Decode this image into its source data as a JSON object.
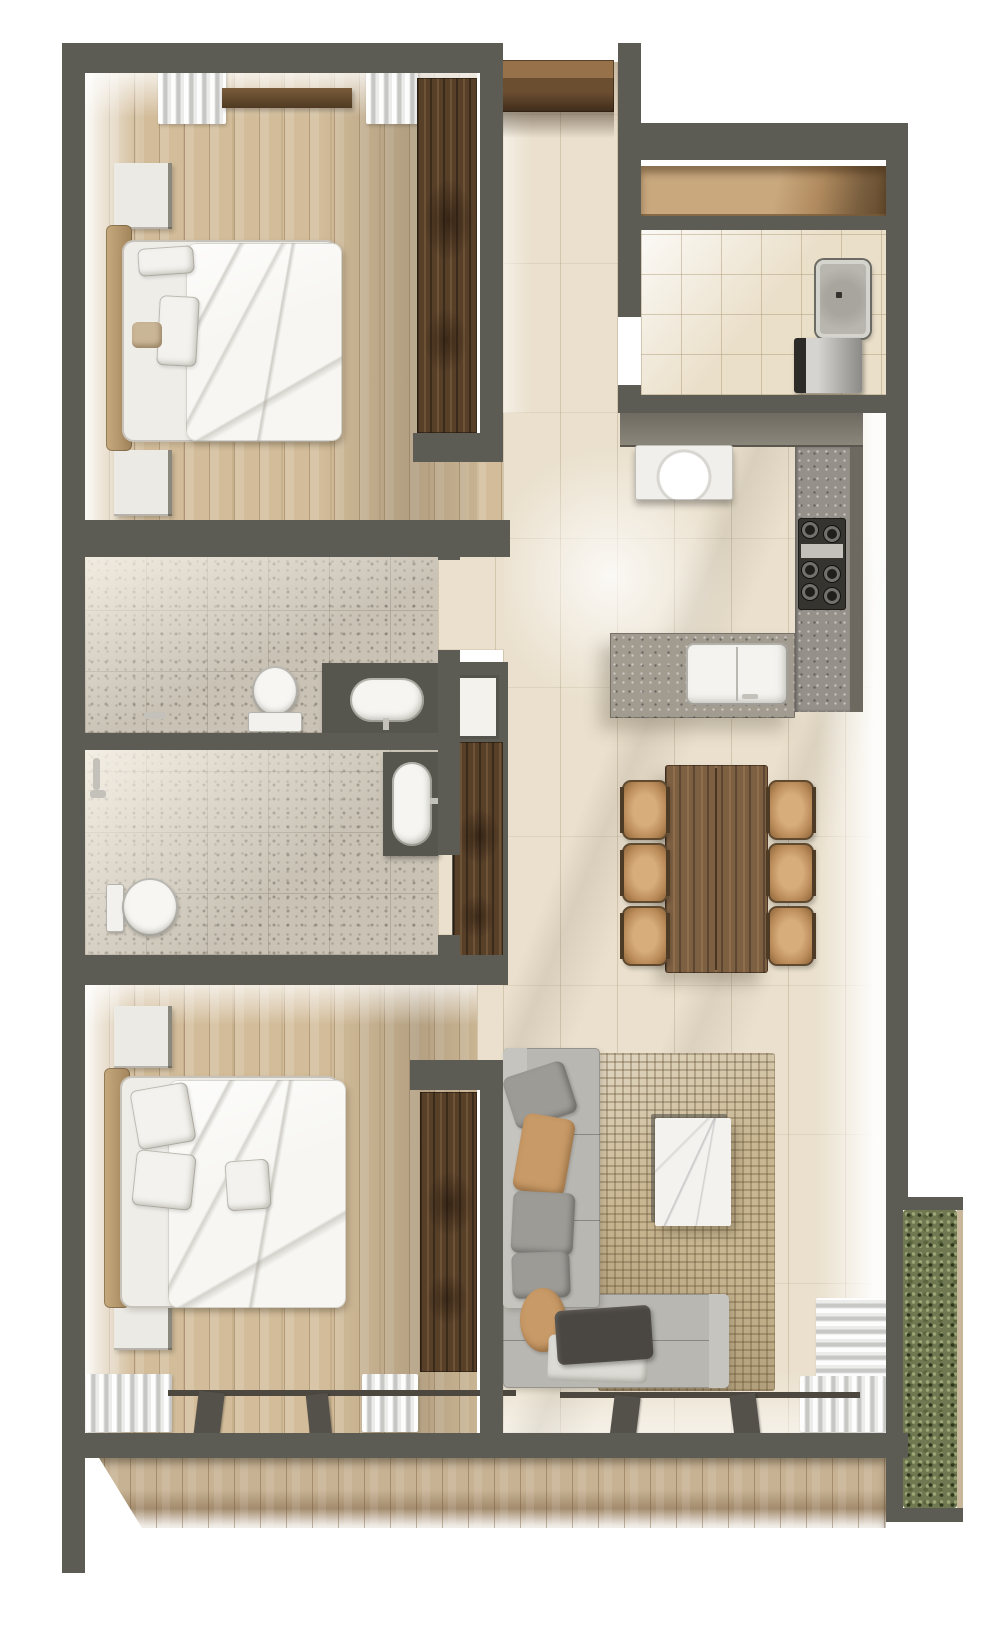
{
  "canvas": {
    "width_px": 1000,
    "height_px": 1641,
    "background": "#ffffff"
  },
  "scene": {
    "type": "3D rendered architectural floor plan",
    "view": "top-down",
    "subject": "two-bedroom apartment with terrace",
    "visible_text": "none"
  },
  "colors": {
    "wall": "#5d5c54",
    "travertine": "#eae0cd",
    "bedroomWood": "#d2bc99",
    "deckWood": "#c7b294",
    "darkWood": "#573f28",
    "terrazzo": "#c9c2b5",
    "creamTile": "#eadfc9",
    "counter": "#7c776d",
    "granite": "#95908a",
    "sofa": "#b9b7b1",
    "rug": "#c8b691",
    "hedge": "#6f7850",
    "fixtureWhite": "#f6f5f1",
    "leatherTan": "#c7a97e",
    "tableWood": "#7d5f42",
    "chairTan": "#c89a67",
    "marble": "#f4f2ee",
    "stove": "#35342f",
    "steel": "#c4c1bb"
  },
  "rooms": [
    {
      "id": "bedroom-1",
      "name": "Bedroom 1",
      "position": "top-left",
      "floor": "wood planks",
      "contents": [
        "double bed with white duvet",
        "two white nightstands",
        "tan headboard bench",
        "built-in dark wood wardrobe",
        "window curtains",
        "wood wall shelf"
      ]
    },
    {
      "id": "entry-hall",
      "name": "Entry Hall",
      "position": "top-center",
      "floor": "travertine tile",
      "contents": [
        "wood entry door canopy"
      ]
    },
    {
      "id": "utility-room",
      "name": "Utility / Laundry Room",
      "position": "top-right",
      "floor": "cream ceramic tile",
      "contents": [
        "built-in storage niche",
        "shower tray",
        "washing machine"
      ]
    },
    {
      "id": "kitchen",
      "name": "Kitchen",
      "position": "right-middle",
      "floor": "travertine tile",
      "contents": [
        "L-shaped granite counter",
        "white countertop appliance",
        "six-burner gas hob",
        "island with inset sink and faucet"
      ]
    },
    {
      "id": "dining-area",
      "name": "Dining Area",
      "position": "center-right",
      "floor": "travertine tile",
      "contents": [
        "rectangular wood dining table",
        "six tan dining chairs"
      ]
    },
    {
      "id": "bathroom-1",
      "name": "Bathroom 1",
      "position": "middle-left",
      "floor": "terrazzo",
      "contents": [
        "toilet",
        "dark vanity with oval sink",
        "wall shower set"
      ]
    },
    {
      "id": "bathroom-2",
      "name": "Bathroom 2",
      "position": "middle-left lower",
      "floor": "terrazzo",
      "contents": [
        "toilet",
        "dark vanity with oval sink",
        "wall shower set"
      ]
    },
    {
      "id": "bedroom-2",
      "name": "Bedroom 2",
      "position": "bottom-left",
      "floor": "wood planks",
      "contents": [
        "double bed with white duvet",
        "two white nightstands",
        "built-in dark wood wardrobe",
        "curtains",
        "sliding glass doors"
      ]
    },
    {
      "id": "living-room",
      "name": "Living Room",
      "position": "bottom-center",
      "floor": "travertine tile",
      "contents": [
        "L-shaped gray sofa",
        "woven jute rug",
        "white marble coffee table",
        "throw pillows",
        "dark throw blanket",
        "curtains",
        "sliding glass doors"
      ]
    },
    {
      "id": "terrace",
      "name": "Terrace",
      "position": "bottom",
      "floor": "wood deck",
      "contents": [
        "hedge planter along right edge"
      ]
    }
  ],
  "counts": {
    "bedrooms": 2,
    "bathrooms": 2,
    "dining_chairs": 6,
    "hob_burners": 6,
    "nightstands": 4,
    "toilets": 2,
    "sinks": 3,
    "beds": 2,
    "wardrobes": 3,
    "curtain_panels": 6
  }
}
